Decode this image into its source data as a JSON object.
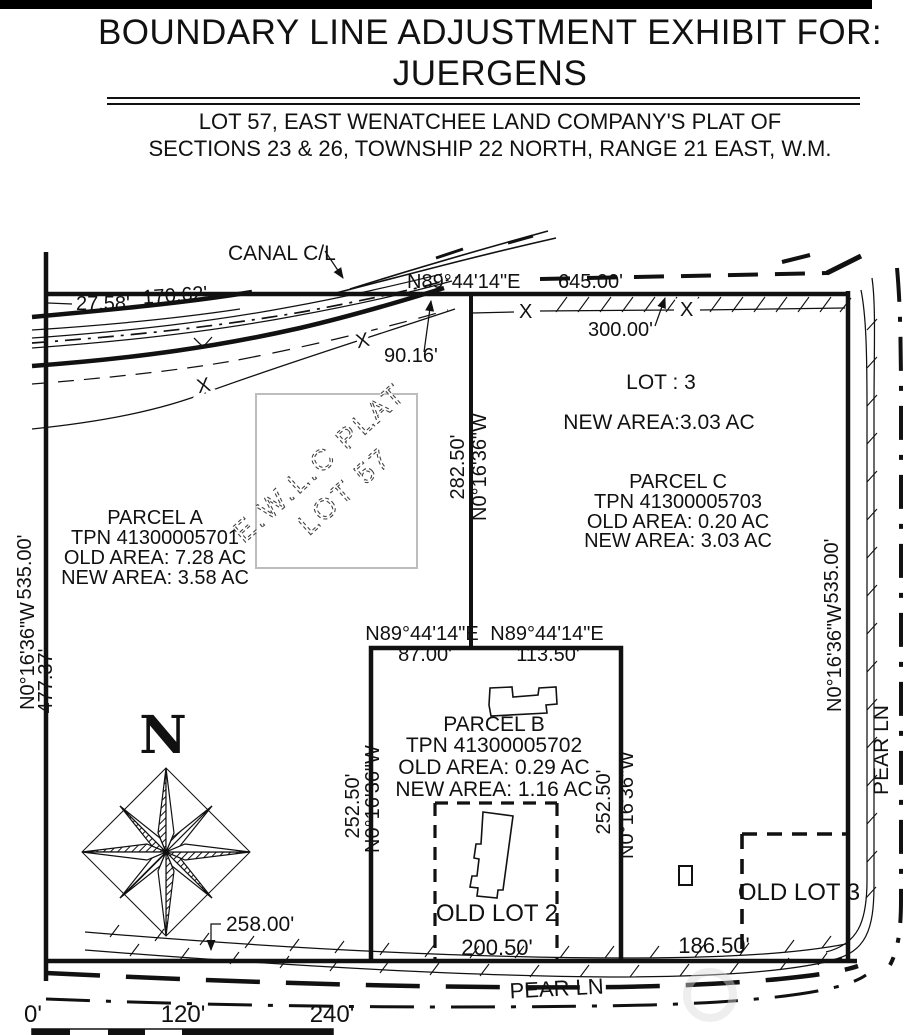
{
  "header": {
    "title_line1": "BOUNDARY LINE ADJUSTMENT EXHIBIT FOR:",
    "title_line2": "JUERGENS",
    "subtitle_line1": "LOT 57, EAST WENATCHEE LAND COMPANY'S PLAT OF",
    "subtitle_line2": "SECTIONS 23 & 26, TOWNSHIP 22 NORTH, RANGE 21 EAST, W.M."
  },
  "map": {
    "labels": {
      "canal_cl": "CANAL C/L",
      "north": "N",
      "x_mark": "X",
      "pear_ln_bottom": "PEAR LN",
      "pear_ln_right": "PEAR LN",
      "old_lot_2": "OLD LOT 2",
      "old_lot_3": "OLD LOT 3"
    },
    "watermark": {
      "line1": "E.W.L.C PLAT",
      "line2": "LOT 57"
    },
    "lot3": {
      "name": "LOT : 3",
      "new_area": "NEW AREA:3.03 AC"
    },
    "parcels": {
      "a": {
        "name": "PARCEL A",
        "tpn": "TPN 41300005701",
        "old_area": "OLD AREA: 7.28 AC",
        "new_area": "NEW AREA: 3.58 AC"
      },
      "b": {
        "name": "PARCEL B",
        "tpn": "TPN 41300005702",
        "old_area": "OLD AREA: 0.29 AC",
        "new_area": "NEW AREA: 1.16 AC"
      },
      "c": {
        "name": "PARCEL C",
        "tpn": "TPN 41300005703",
        "old_area": "OLD AREA: 0.20 AC",
        "new_area": "NEW AREA: 3.03 AC"
      }
    },
    "dimensions": {
      "bearing_east": "N89°44'14\"E",
      "bearing_west": "N0°16'36\"W",
      "top_total": "645.00'",
      "canal_offset": "27.58'",
      "canal_frontage": "170.62'",
      "canal_east": "90.16'",
      "fence": "300.00'",
      "divider": "282.50'",
      "west_north": "535.00'",
      "west_south": "477.37'",
      "east_side": "535.00'",
      "pb_top_west": "87.00'",
      "pb_top_east": "113.50'",
      "pb_side": "252.50'",
      "bottom_west": "258.00'",
      "old_lot2_width": "200.50'",
      "old_lot3_width": "186.50'"
    },
    "scale_bar": {
      "t0": "0'",
      "t1": "120'",
      "t2": "240'"
    },
    "colors": {
      "ink": "#111111",
      "watermark_box": "#bdbdbd"
    }
  }
}
